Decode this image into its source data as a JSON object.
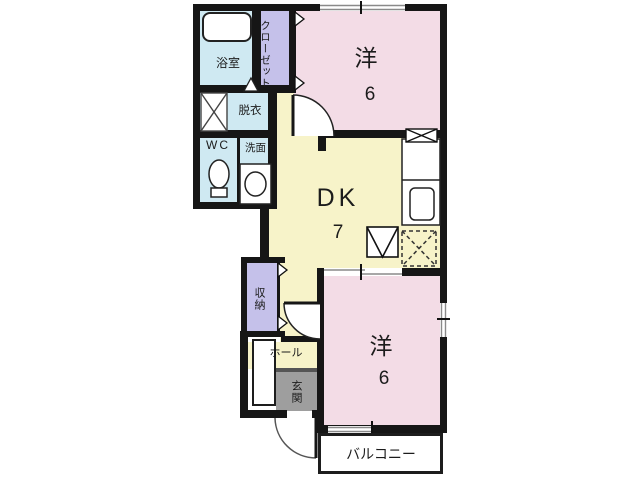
{
  "plan_title": "2DK apartment floor plan",
  "rooms": {
    "bath": {
      "label": "浴室"
    },
    "closet": {
      "label": "クローゼット"
    },
    "dressing": {
      "label": "脱衣"
    },
    "wc": {
      "label": "WC"
    },
    "washroom": {
      "label": "洗面"
    },
    "western_top": {
      "label": "洋",
      "size": "6"
    },
    "dk": {
      "label": "DK",
      "size": "7"
    },
    "storage": {
      "label": "収納"
    },
    "hall": {
      "label": "ホール"
    },
    "entrance": {
      "label": "玄関"
    },
    "western_bottom": {
      "label": "洋",
      "size": "6"
    },
    "balcony": {
      "label": "バルコニー"
    }
  },
  "icons": [
    "bathtub-icon",
    "washing-machine-space-icon",
    "toilet-icon",
    "wash-basin-icon",
    "kitchen-counter-icon",
    "kitchen-sink-icon",
    "range-hood-icon",
    "cooktop-icon",
    "refrigerator-space-icon",
    "door-swing-arc",
    "folding-door-triangle",
    "window-symbol"
  ],
  "colors": {
    "wall": "#161616",
    "room_pink": "#f3dce6",
    "room_yellow": "#f7f3c9",
    "closet_lavender": "#c5c1ea",
    "wet_area_blue": "#cfe9f2",
    "entrance_gray": "#9e9e9e",
    "window_line": "#8a8a8a",
    "background": "#ffffff"
  }
}
